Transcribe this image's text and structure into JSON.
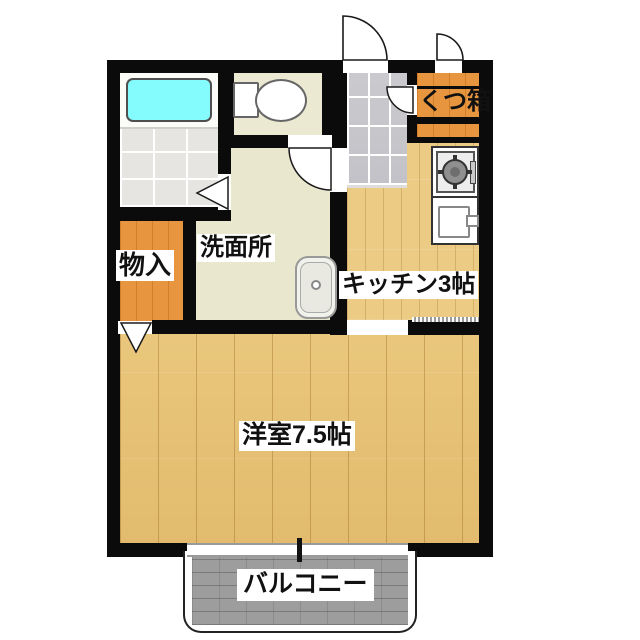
{
  "floor_plan": {
    "labels": {
      "washroom": "洗面所",
      "storage": "物入",
      "kitchen": "キッチン3帖",
      "western_room": "洋室7.5帖",
      "balcony": "バルコニー",
      "shoe_cabinet": "くつ箱"
    },
    "fixtures": {
      "bathtub": "bathtub",
      "toilet": "toilet",
      "washbasin": "washbasin",
      "stove": "gas-stove",
      "kitchen_sink": "kitchen-sink"
    },
    "colors": {
      "wall": "#0b0b0b",
      "wood_floor": "#e9c77c",
      "kitchen_floor": "#eccc85",
      "storage_orange": "#e7953f",
      "bathtub_cyan": "#84fbfc",
      "washroom_floor": "#eae7cf",
      "toilet_floor": "#ece9d2",
      "entrance_tile": "#cacace",
      "balcony_gray": "#9d9d9d"
    }
  }
}
